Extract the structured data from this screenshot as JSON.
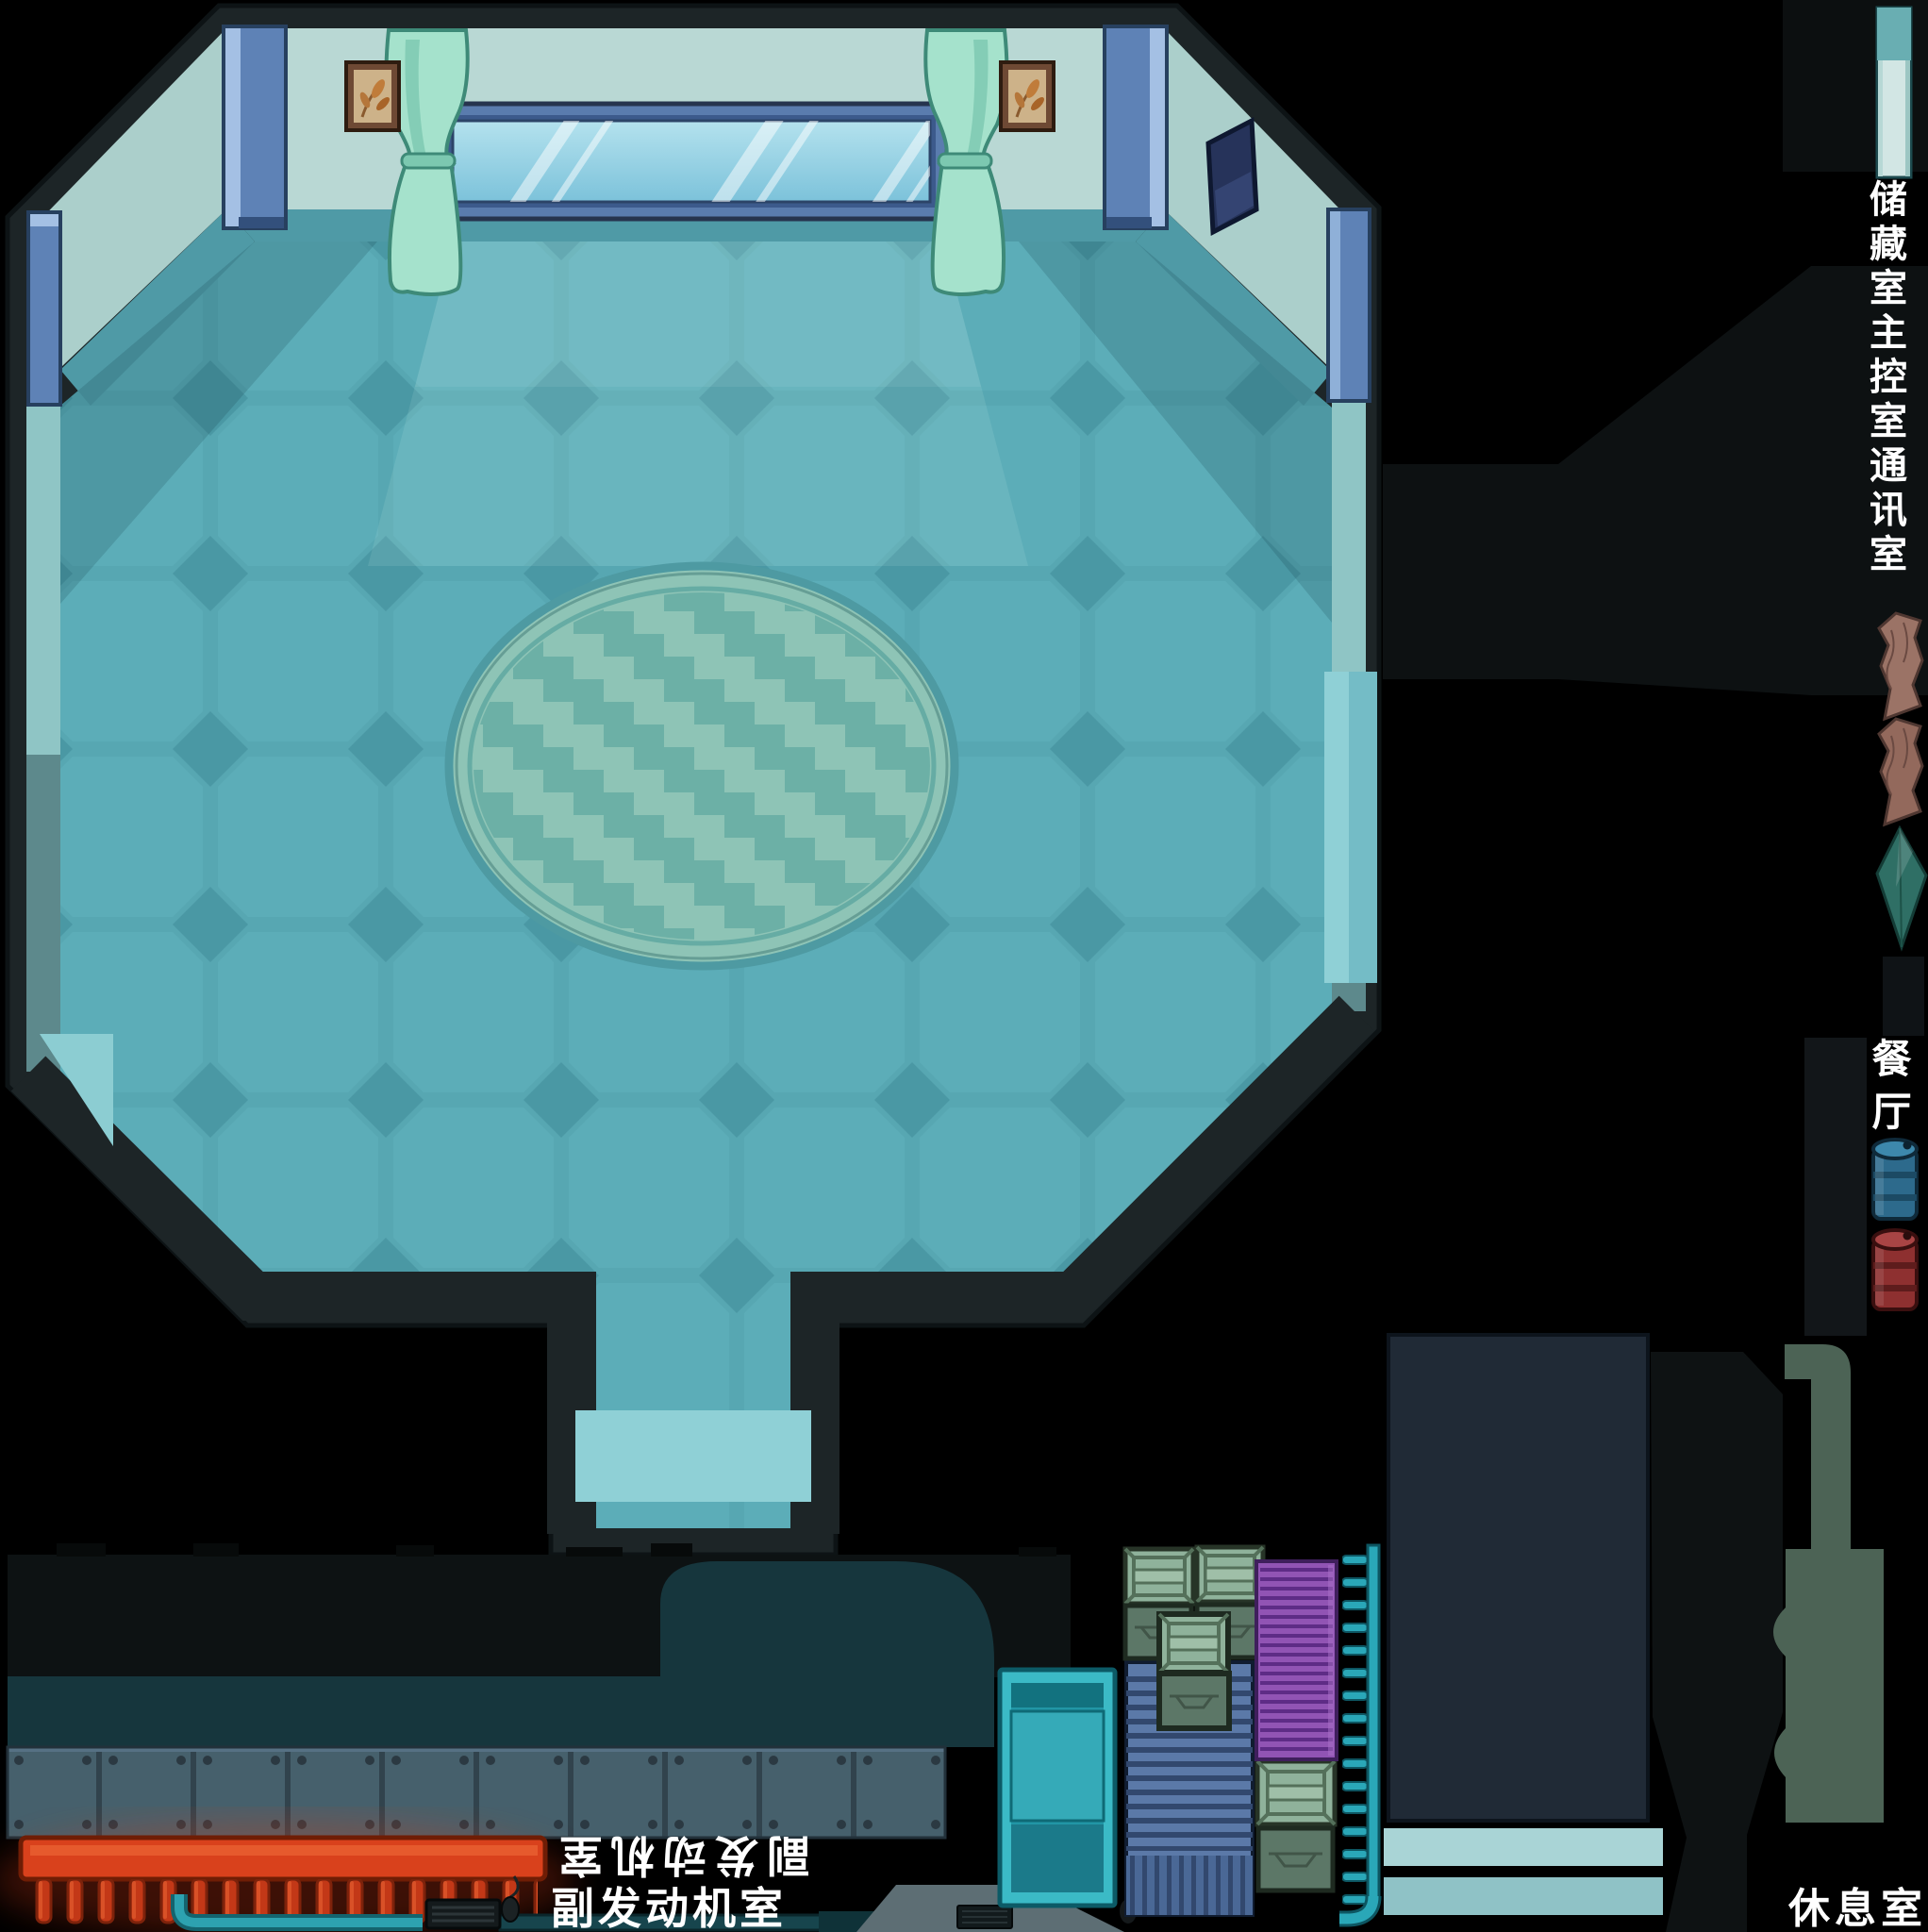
{
  "scene": {
    "type": "game-map",
    "description": "top-down spaceship interior map sheet on black background",
    "background": "#000000"
  },
  "labels": {
    "rooms_column": {
      "text": "储藏室主控室通讯室",
      "orientation": "vertical"
    },
    "dining": {
      "text": "餐厅",
      "orientation": "vertical"
    },
    "aux_engine_flipped": {
      "text": "副发动机室",
      "orientation": "rotated-180"
    },
    "aux_engine": {
      "text": "副发动机室",
      "orientation": "horizontal"
    },
    "lounge": {
      "text": "休息室",
      "orientation": "horizontal"
    }
  },
  "colors": {
    "background": "#000000",
    "wall_dark": "#1d2527",
    "wall_pale": "#b9d8d4",
    "wall_skirting": "#4f9aa6",
    "floor_teal": "#57a7b2",
    "floor_tile_light": "#5cadb8",
    "floor_tile_dark": "#4a98a4",
    "threshold_light": "#8fd0d6",
    "rug_base": "#8ec4b6",
    "rug_zigzag": "#6cb0a6",
    "window_frame_blue": "#5a7cae",
    "glass_blue": "#9fd4e8",
    "curtain_mint": "#a5e2cc",
    "pillar_blue": "#5e82b6",
    "engine_teal": "#16363d",
    "plate_slate": "#46606c",
    "heat_red": "#d9411c",
    "pipe_teal": "#2aa7b8",
    "conveyor_blue": "#5b79a8",
    "crate_light_green": "#8fb29b",
    "crate_dark_green": "#5c7767",
    "radiator_purple": "#9154b4",
    "console_slate": "#202a36",
    "platform_teal": "#a9d4d6",
    "wood_brown": "#9b7366",
    "gem_teal": "#2f6f65",
    "barrel_blue": "#2d6a8c",
    "barrel_red": "#8e3030",
    "label_text": "#ffffff"
  },
  "objects": [
    "octagon-hall",
    "window",
    "curtain-left",
    "curtain-right",
    "plant-picture-left",
    "plant-picture-right",
    "wall-monitor",
    "pillar-top-left",
    "pillar-top-right",
    "pillar-ne",
    "pillar-west",
    "oval-rug",
    "south-corridor",
    "door-threshold",
    "east-exit-light",
    "southwest-exit-light",
    "wall-strip-sprite",
    "wood-planks",
    "teal-gem",
    "blue-barrel",
    "red-barrel",
    "engine-backdrop",
    "armor-plate-row",
    "heat-sink-red",
    "teal-pipe",
    "dark-pipe",
    "keyboard",
    "mouse",
    "vent-grill",
    "vent-door-machine",
    "conveyor-machine",
    "cargo-crates",
    "purple-radiator",
    "pipe-ladder",
    "console-block",
    "platform-bars",
    "shadow-column",
    "faucet-silhouette",
    "shadow-funnel"
  ]
}
